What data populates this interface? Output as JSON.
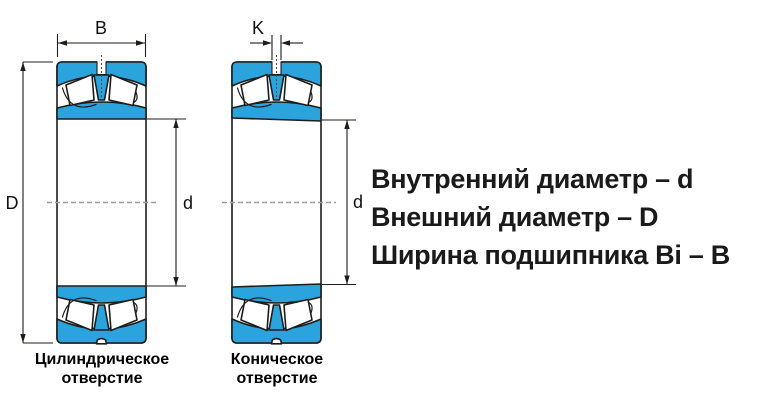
{
  "legend": {
    "line1": "Внутренний диаметр – d",
    "line2": "Внешний диаметр – D",
    "line3": "Ширина подшипника Bi – B"
  },
  "left_bearing": {
    "caption_line1": "Цилиндрическое",
    "caption_line2": "отверстие",
    "labels": {
      "width": "B",
      "outer_diameter": "D",
      "bore_diameter": "d"
    }
  },
  "right_bearing": {
    "caption_line1": "Коническое",
    "caption_line2": "отверстие",
    "labels": {
      "groove_width": "K",
      "bore_diameter": "d"
    }
  },
  "colors": {
    "accent": "#2BA3DC",
    "outline": "#1D1D1B",
    "centerline": "#9B9B9B",
    "ink": "#1A1A1A"
  }
}
